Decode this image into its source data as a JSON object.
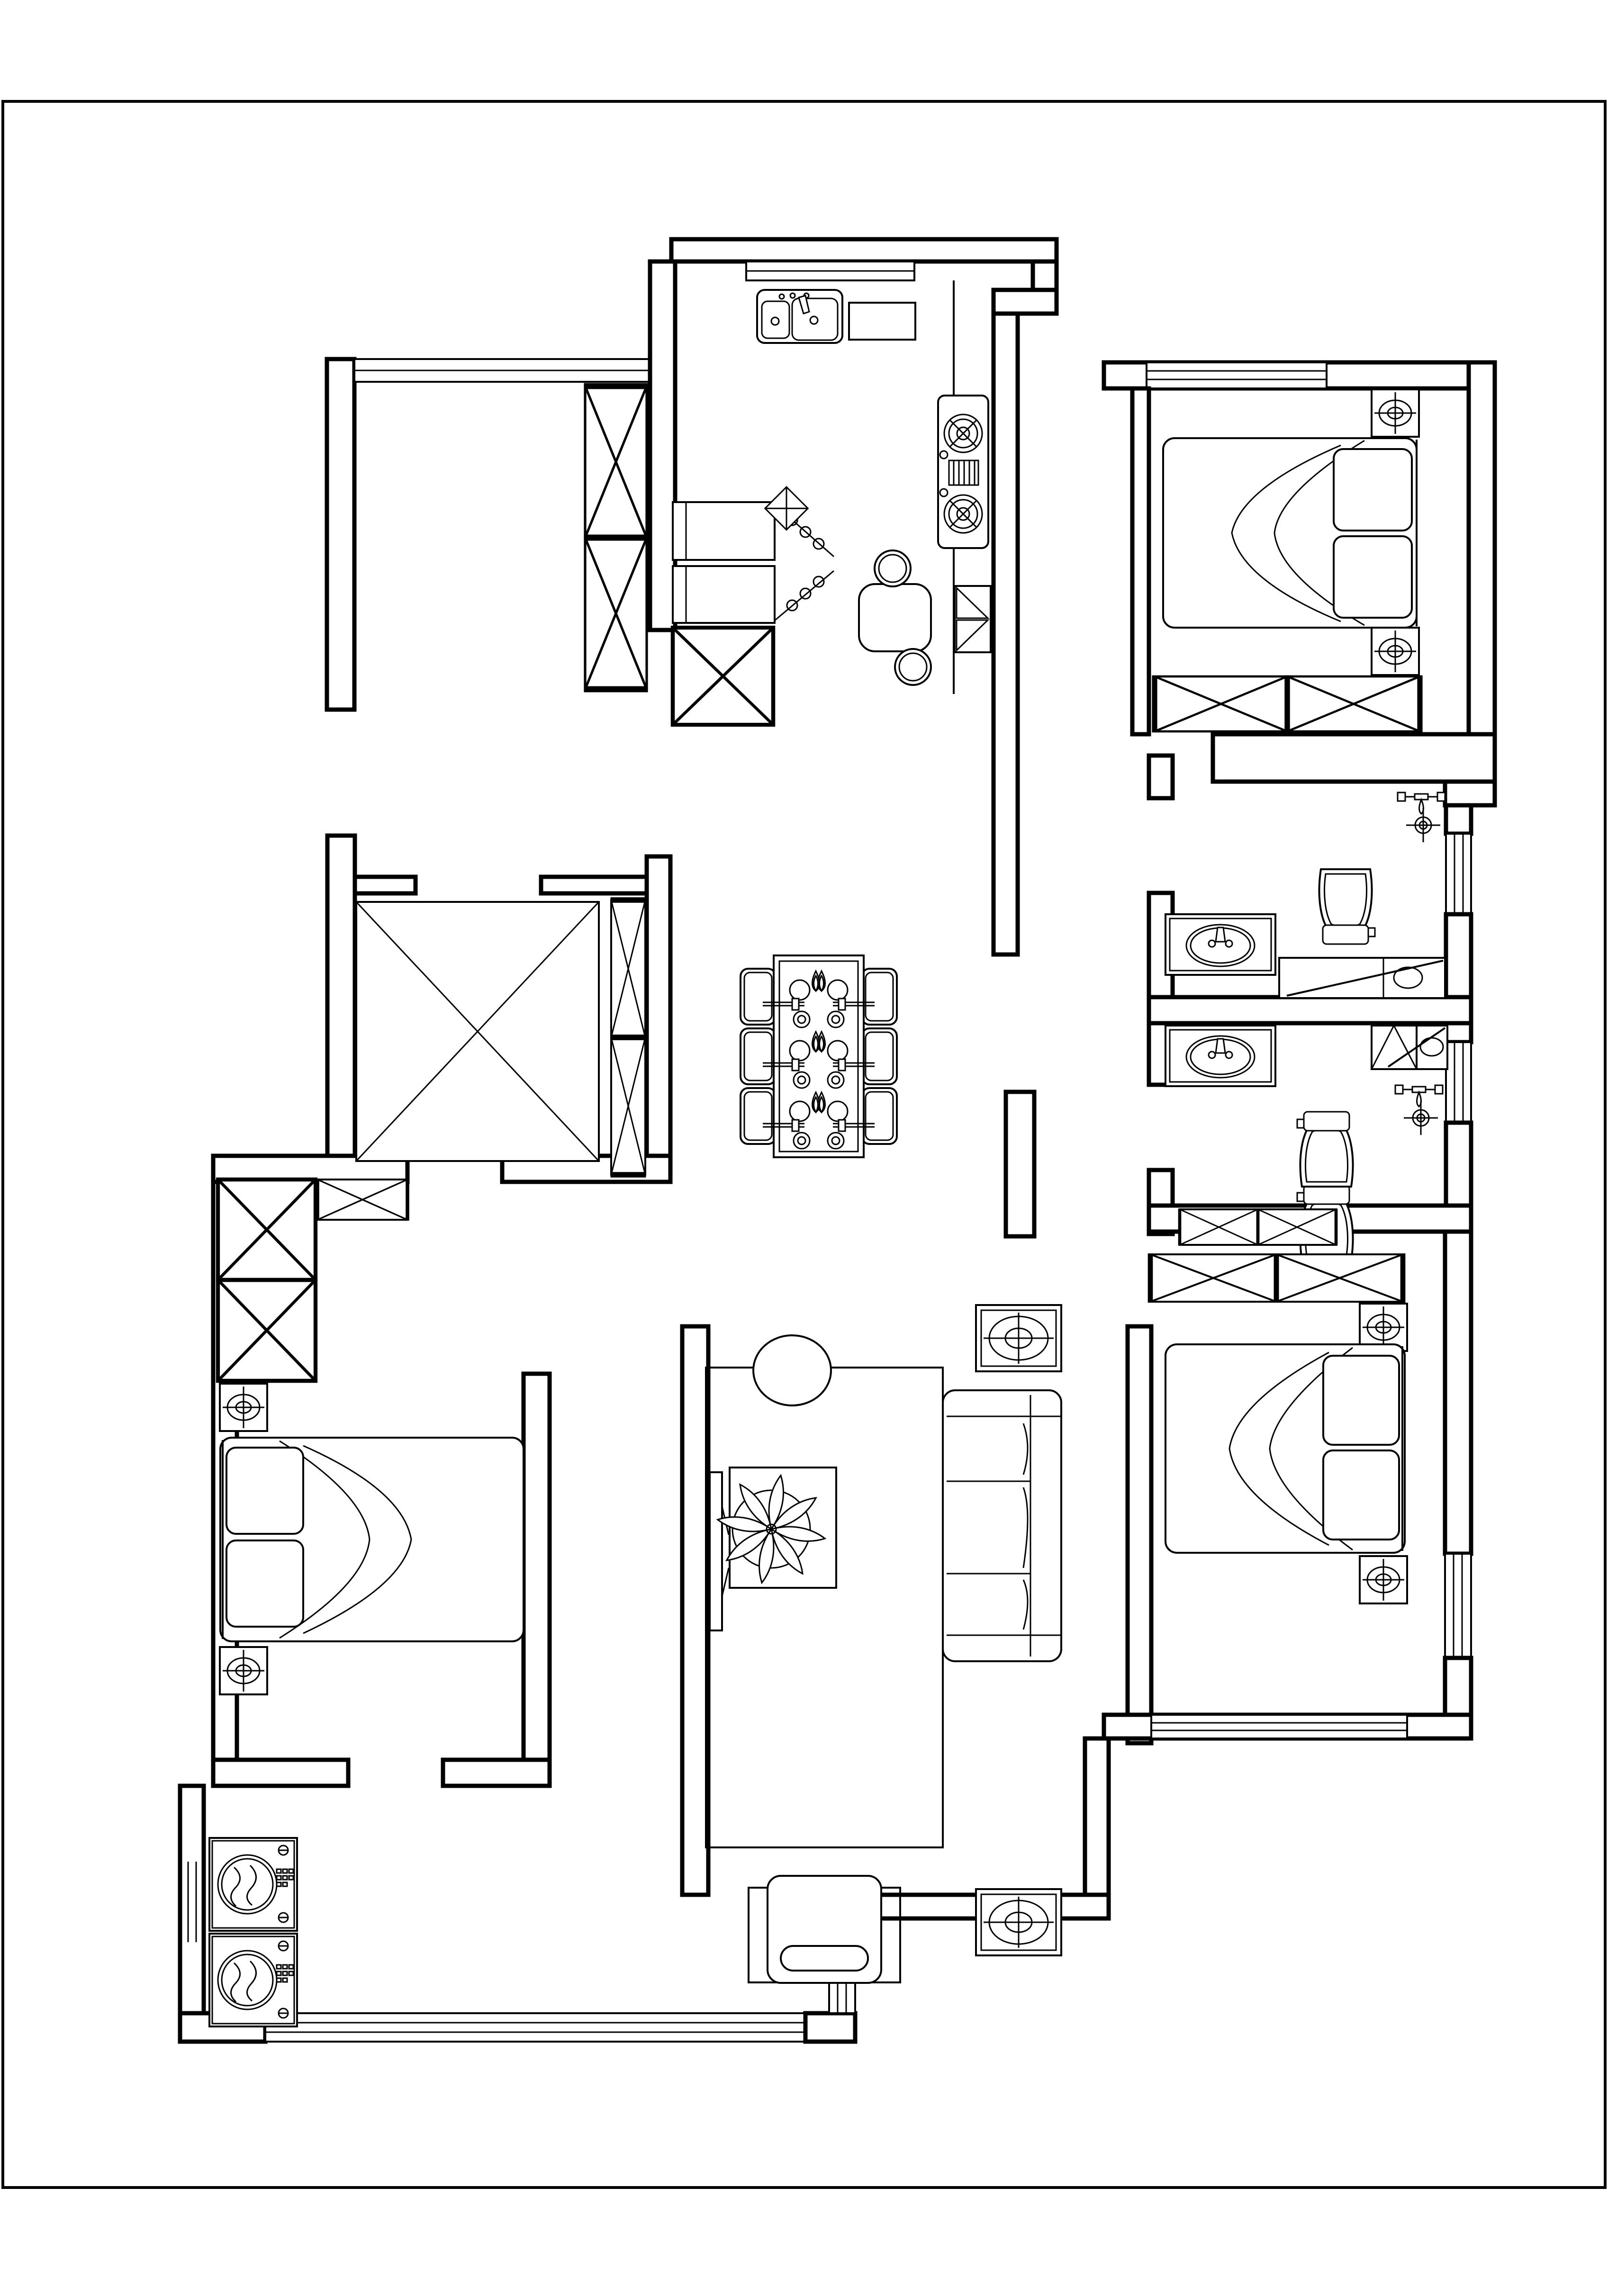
{
  "document": {
    "kind": "residential floor plan, CAD line drawing",
    "background_color": "#ffffff",
    "line_color": "#000000",
    "page_border_color": "#000000",
    "text_labels": []
  },
  "rooms": [
    {
      "id": "balcony-top-left",
      "furniture": [
        "tall storage cabinet (x-hatched, 2 cells)",
        "window band (top)"
      ]
    },
    {
      "id": "kitchen",
      "furniture": [
        "double-basin sink with faucet",
        "countertop block",
        "two-burner gas stove",
        "refrigerator",
        "small bar table",
        "2 round stools",
        "2 hinged wall cabinets",
        "corner diamond shelf",
        "x-hatched base cabinet",
        "top-wall window"
      ]
    },
    {
      "id": "bedroom-top-right",
      "furniture": [
        "double bed with 2 pillows and blanket sweep",
        "2 nightstands with lamp symbol",
        "wardrobe (2 x-cells)",
        "top-wall window"
      ]
    },
    {
      "id": "bathroom-upper",
      "furniture": [
        "vanity with oval basin and faucet",
        "toilet (tank down)",
        "shower head symbol",
        "floor drain",
        "bench with basin and diagonal glass screen",
        "right-wall window"
      ]
    },
    {
      "id": "bathroom-lower",
      "furniture": [
        "vanity with oval basin and faucet",
        "toilet (tank up)",
        "shower head symbol",
        "floor drain",
        "x-hatched cabinet",
        "bench with diagonal screen",
        "right-wall window"
      ]
    },
    {
      "id": "dining-area",
      "furniture": [
        "rectangular dining table",
        "6 chairs",
        "6 place settings (plate, bowl, napkin, chopsticks)"
      ]
    },
    {
      "id": "study-tatami-room",
      "furniture": [
        "large x-hatched tatami platform",
        "tall side cabinet (2 x-cells)"
      ]
    },
    {
      "id": "bedroom-bottom-left",
      "furniture": [
        "double bed with 2 pillows and blanket sweep",
        "2 nightstands with lamp symbol",
        "tall wardrobe (2 x-cells)",
        "overhead x-cabinet",
        "tv partition with television"
      ]
    },
    {
      "id": "living-room",
      "furniture": [
        "area rug",
        "oval ottoman",
        "coffee table with potted plant",
        "three-seat sofa",
        "2 side tables with oval tops",
        "armchair with cushion",
        "television on partition wall"
      ]
    },
    {
      "id": "bedroom-bottom-right",
      "furniture": [
        "double bed with 2 pillows and blanket sweep",
        "2 nightstands with lamp symbol",
        "wardrobe (2 x-cells)",
        "overhead x-cabinet",
        "bottom-wall window",
        "right-wall window"
      ]
    },
    {
      "id": "laundry-balcony-bottom",
      "furniture": [
        "2 front-load washing machines",
        "left-wall window",
        "long bottom window band"
      ]
    }
  ],
  "symbols": [
    "x-hatch-cabinet-icon",
    "nightstand-lamp-icon",
    "floor-drain-icon",
    "shower-head-icon",
    "place-setting-icon",
    "washing-machine-icon",
    "gas-stove-icon",
    "double-sink-icon",
    "toilet-icon",
    "vanity-basin-icon",
    "potted-plant-icon"
  ]
}
